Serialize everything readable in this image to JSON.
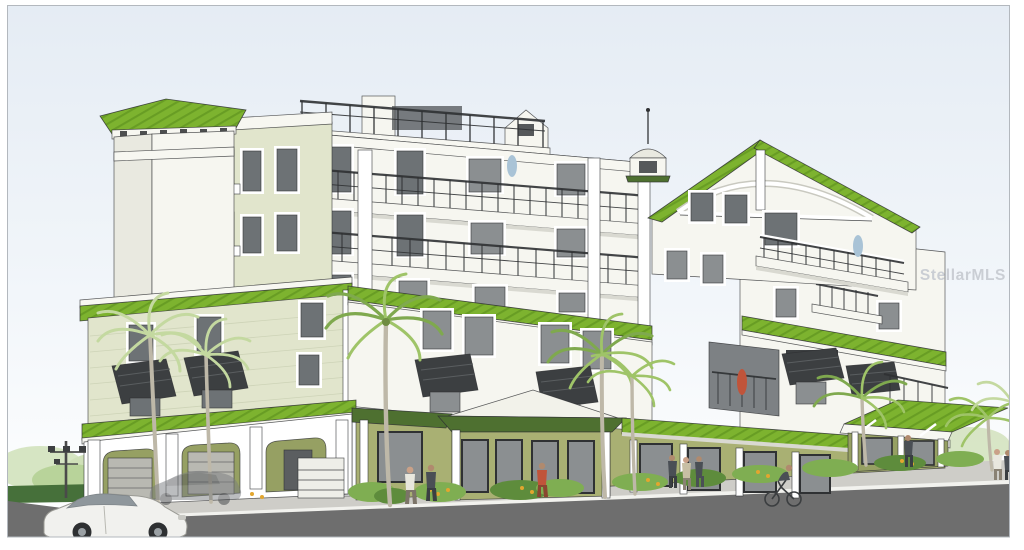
{
  "watermark": {
    "text": "StellarMLS"
  },
  "palette": {
    "paper": "#ffffff",
    "border": "#b3b8be",
    "ink": "#2f3133",
    "sky_top": "#e5ecf4",
    "sky_mid": "#f2f6fa",
    "sky_bottom": "#ffffff",
    "roof_green": "#7db32f",
    "roof_seam": "#689d24",
    "roof_dark": "#4e7030",
    "fascia": "#f7f7f1",
    "wall_white": "#f6f6f0",
    "wall_shade": "#e9e9e0",
    "wall_sage": "#e1e5cc",
    "sage_line": "#c9cfb2",
    "wall_olive": "#a9b073",
    "olive_shade": "#96a063",
    "glass": "#8b8f91",
    "glass_dark": "#6d7275",
    "trim": "#ffffff",
    "shutter": "#3c3f41",
    "corbel": "#8a5a2e",
    "road": "#6e6e6e",
    "sidewalk": "#cecdc8",
    "curb": "#f2f2ee",
    "hedge": "#46703a",
    "tree_light": "#cfe0b8",
    "shrub": "#7fae52",
    "shrub_dark": "#5e8c3c",
    "palm_dark": "#7fa94e",
    "palm": "#9fc468",
    "palm_light": "#c4d9a0",
    "trunk": "#beb8a8",
    "flower": "#e2a62f",
    "car_white": "#f1f1ee",
    "ghost": "#7a7d80",
    "fig_dark": "#4a4f55",
    "fig_red": "#c0543a",
    "fig_blue": "#a9c3d6",
    "fig_light": "#e9e7de",
    "watermark_color": "#c6cad1"
  },
  "scene": {
    "objects": [
      "condo-building-rendering",
      "green-metal-roofs",
      "balconies",
      "elevator-tower",
      "gable-tower-with-cupola",
      "street-level-storefronts",
      "arcade-garages",
      "palm-trees",
      "white-hatchback-car",
      "ghost-sedan",
      "pedestrians",
      "cyclist",
      "street",
      "sidewalk",
      "traffic-signal-pole",
      "sky"
    ]
  }
}
